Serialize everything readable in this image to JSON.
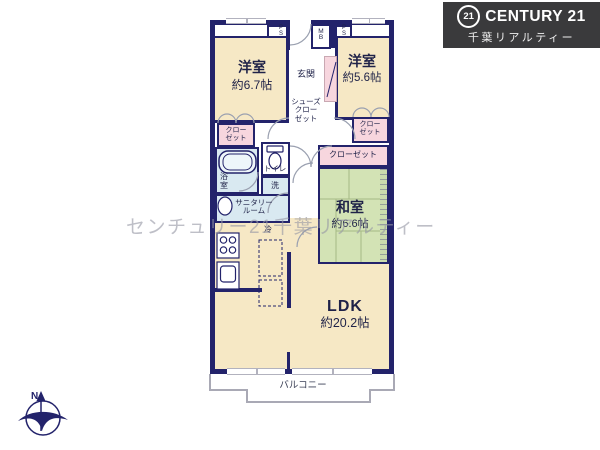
{
  "brand": {
    "badge": "21",
    "name": "CENTURY 21",
    "company": "千葉リアルティー",
    "bg_color": "#3a3a3c"
  },
  "watermark": "センチュリー21千葉リアルティー",
  "compass": {
    "north": "N"
  },
  "colors": {
    "wall": "#23236b",
    "western_room": "#f6e8c5",
    "tatami_room": "#d3e3b5",
    "closet": "#f7d6de",
    "wet_area": "#d9e9f1",
    "window": "#b2b2be",
    "balcony_line": "#a9a9b5",
    "text": "#1f2248"
  },
  "labels": {
    "yoshitsu1_name": "洋室",
    "yoshitsu1_size": "約6.7帖",
    "yoshitsu2_name": "洋室",
    "yoshitsu2_size": "約5.6帖",
    "washitsu_name": "和室",
    "washitsu_size": "約6.6帖",
    "ldk_name": "LDK",
    "ldk_size": "約20.2帖",
    "genkan": "玄関",
    "shoes_l1": "シューズ",
    "shoes_l2": "クロー",
    "shoes_l3": "ゼット",
    "closet_l1": "クロー",
    "closet_l2": "ゼット",
    "closet_wide": "クローゼット",
    "bath_l1": "浴",
    "bath_l2": "室",
    "toilet": "トイレ",
    "laundry": "洗",
    "sanitary_l1": "サニタリー",
    "sanitary_l2": "ルーム",
    "fridge": "冷",
    "balcony": "バルコニー",
    "ps_l1": "P",
    "ps_l2": "S",
    "mb_l1": "M",
    "mb_l2": "B"
  }
}
